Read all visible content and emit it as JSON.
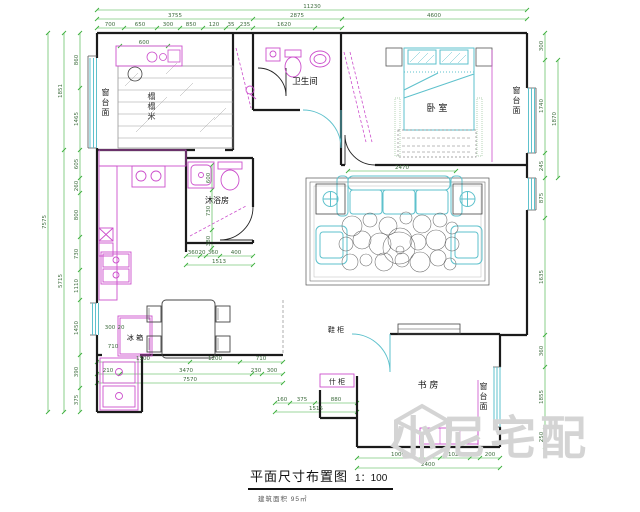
{
  "title": {
    "name": "平面尺寸布置图",
    "scale": "1：100",
    "note": "建筑面积 95㎡"
  },
  "watermark": {
    "text": "小尼宅配"
  },
  "labels": {
    "bathroom": "卫生间",
    "bedroom": "卧 室",
    "shower_room": "沐浴房",
    "study": "书 房",
    "tatami": "榻榻米",
    "window_sill": "窗台面",
    "fridge": "冰 箱",
    "shoe_cabinet": "鞋 柜",
    "hall_cabinet": "什 柜"
  },
  "colors": {
    "wall": "#1b1b1b",
    "furniture": "#cc4fcc",
    "window": "#5ec1cc",
    "dimension_line": "#3db03d",
    "dimension_text": "#3d6b3d",
    "watermark": "#d4d4d4"
  },
  "dims": {
    "top": {
      "total": "11230",
      "seg_left": "3755",
      "seg_mid": "2875",
      "seg_right": "4600",
      "d1": "700",
      "d2": "650",
      "d3": "300",
      "d4": "850",
      "d5": "120",
      "d6": "35",
      "d7": "235",
      "d8": "1620"
    },
    "left": {
      "d1": "860",
      "d2": "1465",
      "d3": "605",
      "d4": "260",
      "d5": "800",
      "d6": "730",
      "d7": "1110",
      "d8": "1450",
      "d9": "390",
      "d10": "375",
      "m1": "1851",
      "m2": "5715",
      "total": "7575"
    },
    "right": {
      "d1": "300",
      "d2": "1740",
      "d3": "245",
      "d4": "875",
      "d5": "1635",
      "d6": "360",
      "d7": "1855",
      "d8": "250",
      "outer": "1870"
    },
    "bottom_left": {
      "d1": "1500",
      "d2": "1200",
      "d3": "710",
      "e1": "210",
      "e2": "3470",
      "e3": "230",
      "e4": "300",
      "total": "7570"
    },
    "bottom_right": {
      "d1": "1000",
      "d2": "1020",
      "d3": "100",
      "d4": "200",
      "total": "2400"
    },
    "corridor": {
      "d1": "160",
      "d2": "375",
      "d3": "880",
      "total": "1515"
    },
    "kitchen": {
      "v1": "600",
      "v2": "730",
      "v3": "380",
      "h1": "360",
      "h2": "20",
      "h3": "360",
      "h4": "400",
      "total": "1513",
      "f1": "300",
      "f2": "20",
      "f3": "710"
    },
    "balcony": {
      "w": "600"
    },
    "living": {
      "w": "2470"
    }
  }
}
